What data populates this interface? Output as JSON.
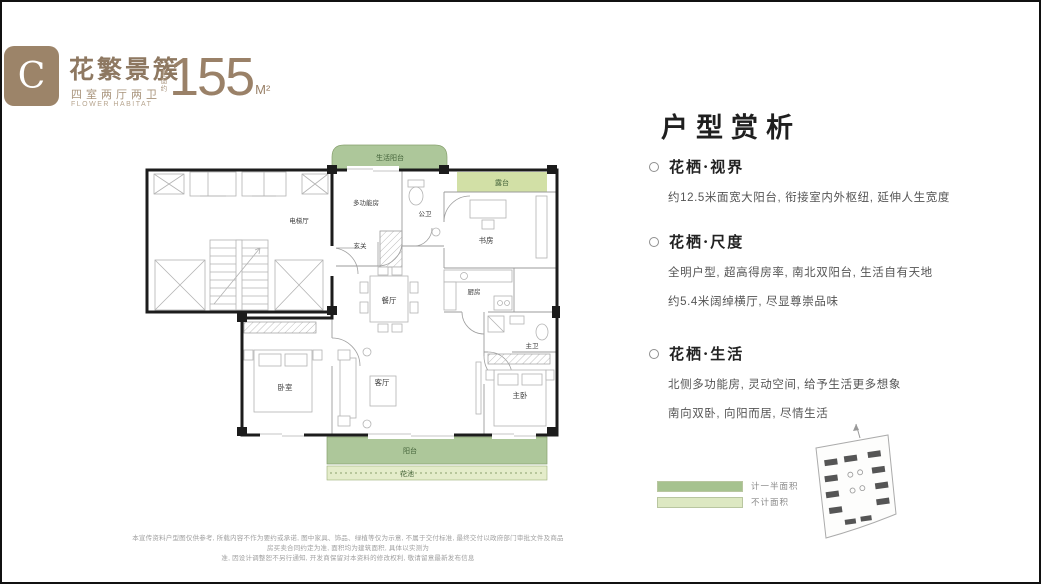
{
  "header": {
    "badge_letter": "C",
    "badge_color": "#9c8469",
    "title": "花繁景簇",
    "subtitle": "四室两厅两卫",
    "subtitle_en": "FLOWER HABITAT",
    "area_prefix": "建面约",
    "area_value": "155",
    "area_unit": "M²"
  },
  "plan": {
    "rooms": {
      "life_balcony": "生活阳台",
      "terrace": "露台",
      "multi_room": "多功能房",
      "public_bath": "公卫",
      "elevator_hall": "电梯厅",
      "foyer": "玄关",
      "study": "书房",
      "kitchen": "厨房",
      "dining": "餐厅",
      "living": "客厅",
      "bedroom": "卧室",
      "master_bedroom": "主卧",
      "master_bath": "主卫",
      "balcony": "阳台",
      "flower_bed": "花池"
    },
    "colors": {
      "balcony_half_area": "#a6c28f",
      "balcony_no_area": "#dde8c2",
      "wall": "#1c1c1c"
    }
  },
  "analysis": {
    "title": "户型赏析",
    "sections": [
      {
        "title": "花栖·视界",
        "lines": [
          "约12.5米面宽大阳台, 衔接室内外枢纽, 延伸人生宽度"
        ]
      },
      {
        "title": "花栖·尺度",
        "lines": [
          "全明户型, 超高得房率, 南北双阳台, 生活自有天地",
          "约5.4米阔绰横厅, 尽显尊崇品味"
        ]
      },
      {
        "title": "花栖·生活",
        "lines": [
          "北侧多功能房, 灵动空间, 给予生活更多想象",
          "南向双卧, 向阳而居, 尽情生活"
        ]
      }
    ]
  },
  "legend": {
    "items": [
      {
        "color": "#a6c28f",
        "label": "计一半面积"
      },
      {
        "color": "#dde8c2",
        "label": "不计面积"
      }
    ]
  },
  "disclaimer": {
    "line1": "本宣传资料户型图仅供参考, 所载内容不作为要约或承诺, 图中家具、饰品、绿植等仅为示意, 不属于交付标准, 最终交付以政府部门审批文件及商品房买卖合同约定为准, 面积均为建筑面积, 具体以实测为",
    "line2": "准, 因设计调整恕不另行通知, 开发商保留对本资料的修改权利, 敬请留意最新发布信息"
  }
}
